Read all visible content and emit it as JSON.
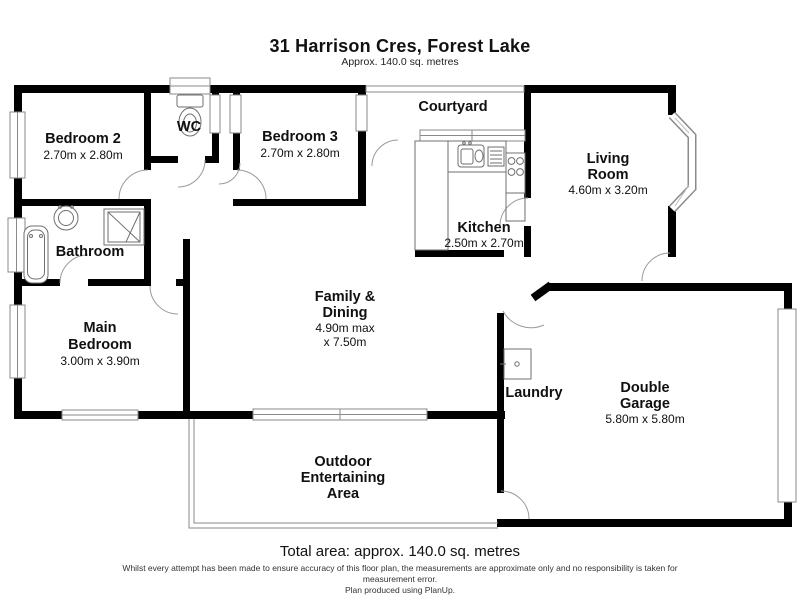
{
  "header": {
    "title": "31 Harrison Cres, Forest Lake",
    "subtitle": "Approx. 140.0 sq. metres"
  },
  "footer": {
    "total_area": "Total area: approx. 140.0 sq. metres",
    "disclaimer_line1": "Whilst every attempt has been made to ensure accuracy of this floor plan, the measurements are approximate only and no responsibility is taken for",
    "disclaimer_line2": "measurement error.",
    "credit": "Plan produced using PlanUp."
  },
  "rooms": {
    "bedroom2": {
      "name": "Bedroom 2",
      "dims": "2.70m x 2.80m"
    },
    "wc": {
      "name": "WC"
    },
    "bedroom3": {
      "name": "Bedroom 3",
      "dims": "2.70m x 2.80m"
    },
    "courtyard": {
      "name": "Courtyard"
    },
    "living": {
      "name_line1": "Living",
      "name_line2": "Room",
      "dims": "4.60m x 3.20m"
    },
    "kitchen": {
      "name": "Kitchen",
      "dims": "2.50m x 2.70m"
    },
    "bathroom": {
      "name": "Bathroom"
    },
    "main_bedroom": {
      "name_line1": "Main",
      "name_line2": "Bedroom",
      "dims": "3.00m x 3.90m"
    },
    "family_dining": {
      "name_line1": "Family &",
      "name_line2": "Dining",
      "dims_line1": "4.90m max",
      "dims_line2": "x 7.50m"
    },
    "laundry": {
      "name": "Laundry"
    },
    "garage": {
      "name_line1": "Double",
      "name_line2": "Garage",
      "dims": "5.80m x 5.80m"
    },
    "outdoor": {
      "name_line1": "Outdoor",
      "name_line2": "Entertaining",
      "name_line3": "Area"
    }
  },
  "colors": {
    "wall": "#000000",
    "thin_line": "#8a8a8a",
    "text": "#101010",
    "background": "#ffffff"
  }
}
